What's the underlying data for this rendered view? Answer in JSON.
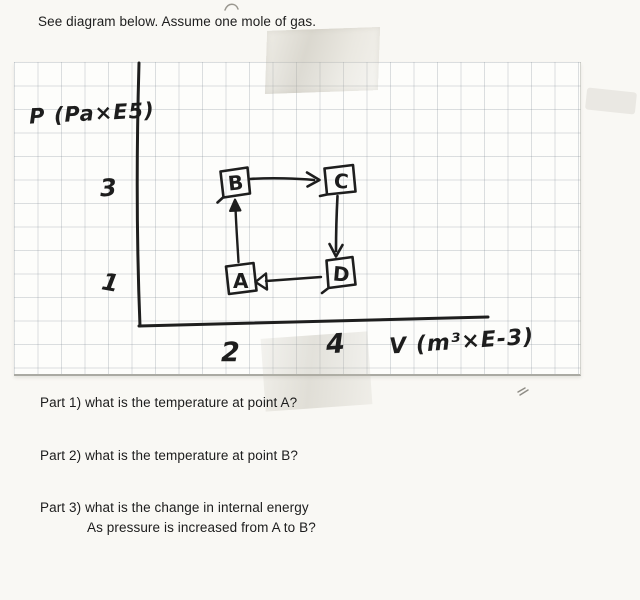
{
  "page": {
    "intro_text": "See diagram below. Assume one mole of gas."
  },
  "chart_data": {
    "type": "scatter",
    "xlabel": "V (m³×E-3)",
    "ylabel": "P (Pa×E5)",
    "x_ticks": [
      "2",
      "4"
    ],
    "y_ticks": [
      "3",
      "1"
    ],
    "x_range_shown": [
      0,
      9
    ],
    "y_range_shown": [
      0,
      5
    ],
    "points": [
      {
        "label": "A",
        "V": 2,
        "P": 1
      },
      {
        "label": "B",
        "V": 2,
        "P": 3
      },
      {
        "label": "C",
        "V": 4,
        "P": 3
      },
      {
        "label": "D",
        "V": 4,
        "P": 1
      }
    ],
    "process_arrows": [
      "A→B",
      "B→C",
      "C→D",
      "D→A"
    ],
    "style": "hand-drawn boxes around each state letter, drawn on graph paper"
  },
  "questions": [
    {
      "label": "Part 1)",
      "text": "what is the temperature at point A?"
    },
    {
      "label": "Part 2)",
      "text": "what is the temperature at point B?"
    },
    {
      "label": "Part 3)",
      "text": "what is the change in internal energy",
      "text2": "As pressure is increased from A to B?"
    }
  ]
}
